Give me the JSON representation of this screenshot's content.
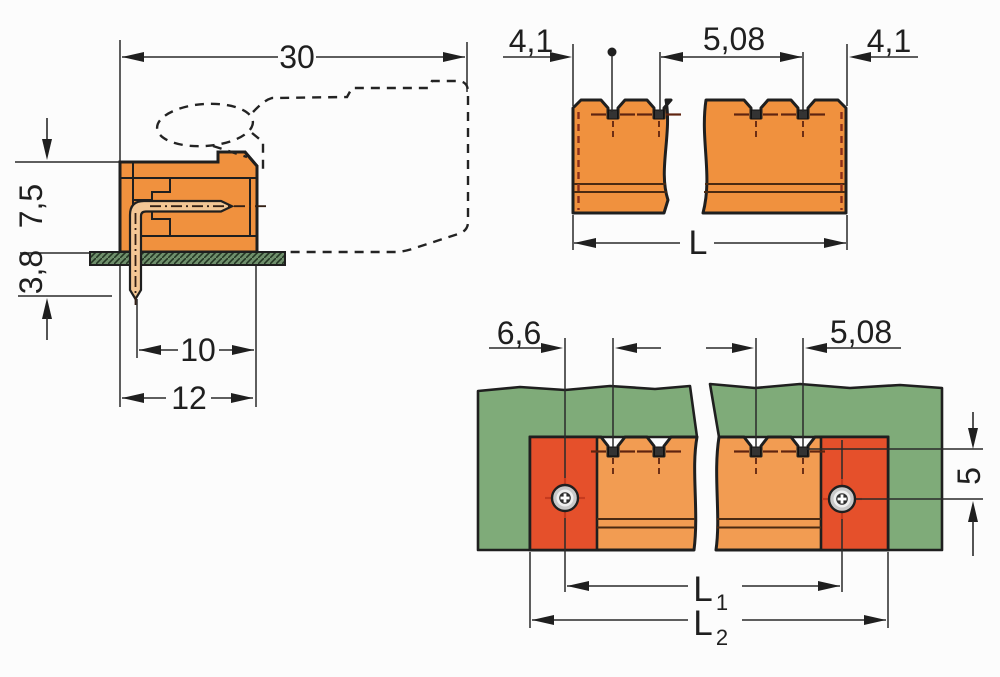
{
  "drawing": {
    "side_view": {
      "total_depth": "30",
      "height_above_board": "7,5",
      "pin_length_below_board": "3,8",
      "pin_to_front": "10",
      "body_depth": "12"
    },
    "front_view": {
      "edge_to_first_pin": "4,1",
      "pin_pitch": "5,08",
      "edge_to_last_pin": "4,1",
      "total_length": "L"
    },
    "board_view": {
      "screw_to_first_pin": "6,6",
      "pin_pitch": "5,08",
      "pin_row_to_screw": "5",
      "screw_spacing_base": "L",
      "screw_spacing_sub": "1",
      "overall_length_base": "L",
      "overall_length_sub": "2"
    }
  },
  "colors": {
    "body_orange": "#F0913E",
    "body_orange_light": "#F29C52",
    "flange_red": "#E5502B",
    "pcb_green": "#7FAB79",
    "pin_copper": "#F3C795",
    "board_strip_green": "#6E8E6B",
    "outline_dark": "#1F1F1F",
    "hidden_line_red": "#8B2E1A",
    "screw_tick_red": "#C63A1E"
  }
}
